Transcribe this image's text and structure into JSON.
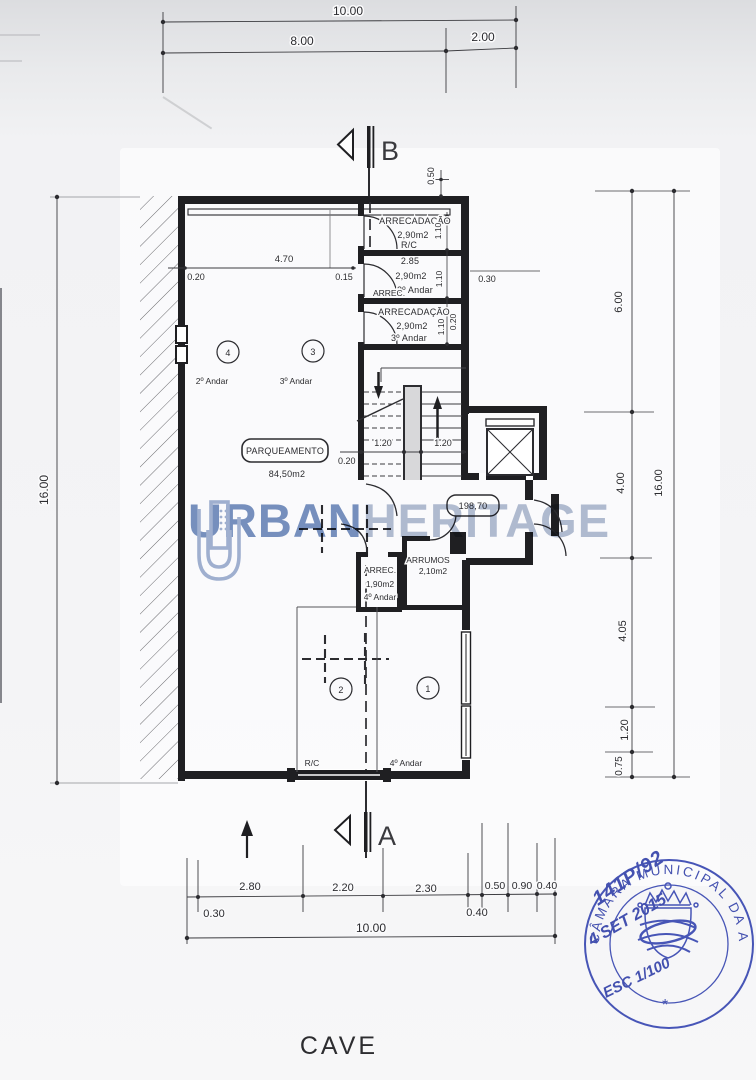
{
  "title": {
    "floor": "CAVE"
  },
  "watermark": {
    "left": "URBAN",
    "right": "HERITAGE"
  },
  "sections": {
    "top": "B",
    "bottom": "A"
  },
  "dims_top": {
    "total": "10.00",
    "seg_a": "8.00",
    "seg_b": "2.00"
  },
  "dims_left": {
    "total": "16.00"
  },
  "dims_right": {
    "s1": "6.00",
    "s2": "4.00",
    "s3": "4.05",
    "s4": "1.20",
    "s5": "0.75",
    "total": "16.00"
  },
  "dims_bottom": {
    "s1": "2.80",
    "s2": "2.20",
    "s3": "2.30",
    "s4": "0.50",
    "s5": "0.90",
    "s6": "0.40",
    "off_l": "0.30",
    "off_r": "0.40",
    "total": "10.00"
  },
  "dims_plan": {
    "parapet": "0.50",
    "right_off": "0.30",
    "left_off": "0.20",
    "garage_w": "4.70",
    "wall_gap": "0.15",
    "storage_w": "2.85",
    "d110_a": "1.10",
    "d110_b": "1.10",
    "d110_c": "1.10",
    "d020_a": "0.20",
    "stair_l": "1.20",
    "stair_r": "1.20",
    "d020_b": "0.20"
  },
  "rooms": {
    "s1_name": "ARRECADAÇÃO",
    "s1_area": "2,90m2",
    "s1_floor": "R/C",
    "s2_name": "ARREC.",
    "s2_area": "2,90m2",
    "s2_floor": "2º Andar",
    "s3_name": "ARRECADAÇÃO",
    "s3_area": "2,90m2",
    "s3_floor": "3º Andar",
    "s4_name": "ARREC.",
    "s4_area": "1,90m2",
    "s4_floor": "4º Andar",
    "arrumos_name": "ARRUMOS",
    "arrumos_area": "2,10m2",
    "park_name": "PARQUEAMENTO",
    "park_area": "84,50m2",
    "level": "198,70"
  },
  "spaces": {
    "c1": "1",
    "c2": "2",
    "c3": "3",
    "c4": "4",
    "f4": "2º Andar",
    "f3": "3º Andar",
    "f2": "R/C",
    "f1": "4º Andar"
  },
  "stamp": {
    "authority": "CÂMARA MUNICIPAL DA AMADORA",
    "process": "141P/92",
    "date": "4 SET 2015",
    "scale": "ESC 1/100",
    "mark": "*"
  }
}
